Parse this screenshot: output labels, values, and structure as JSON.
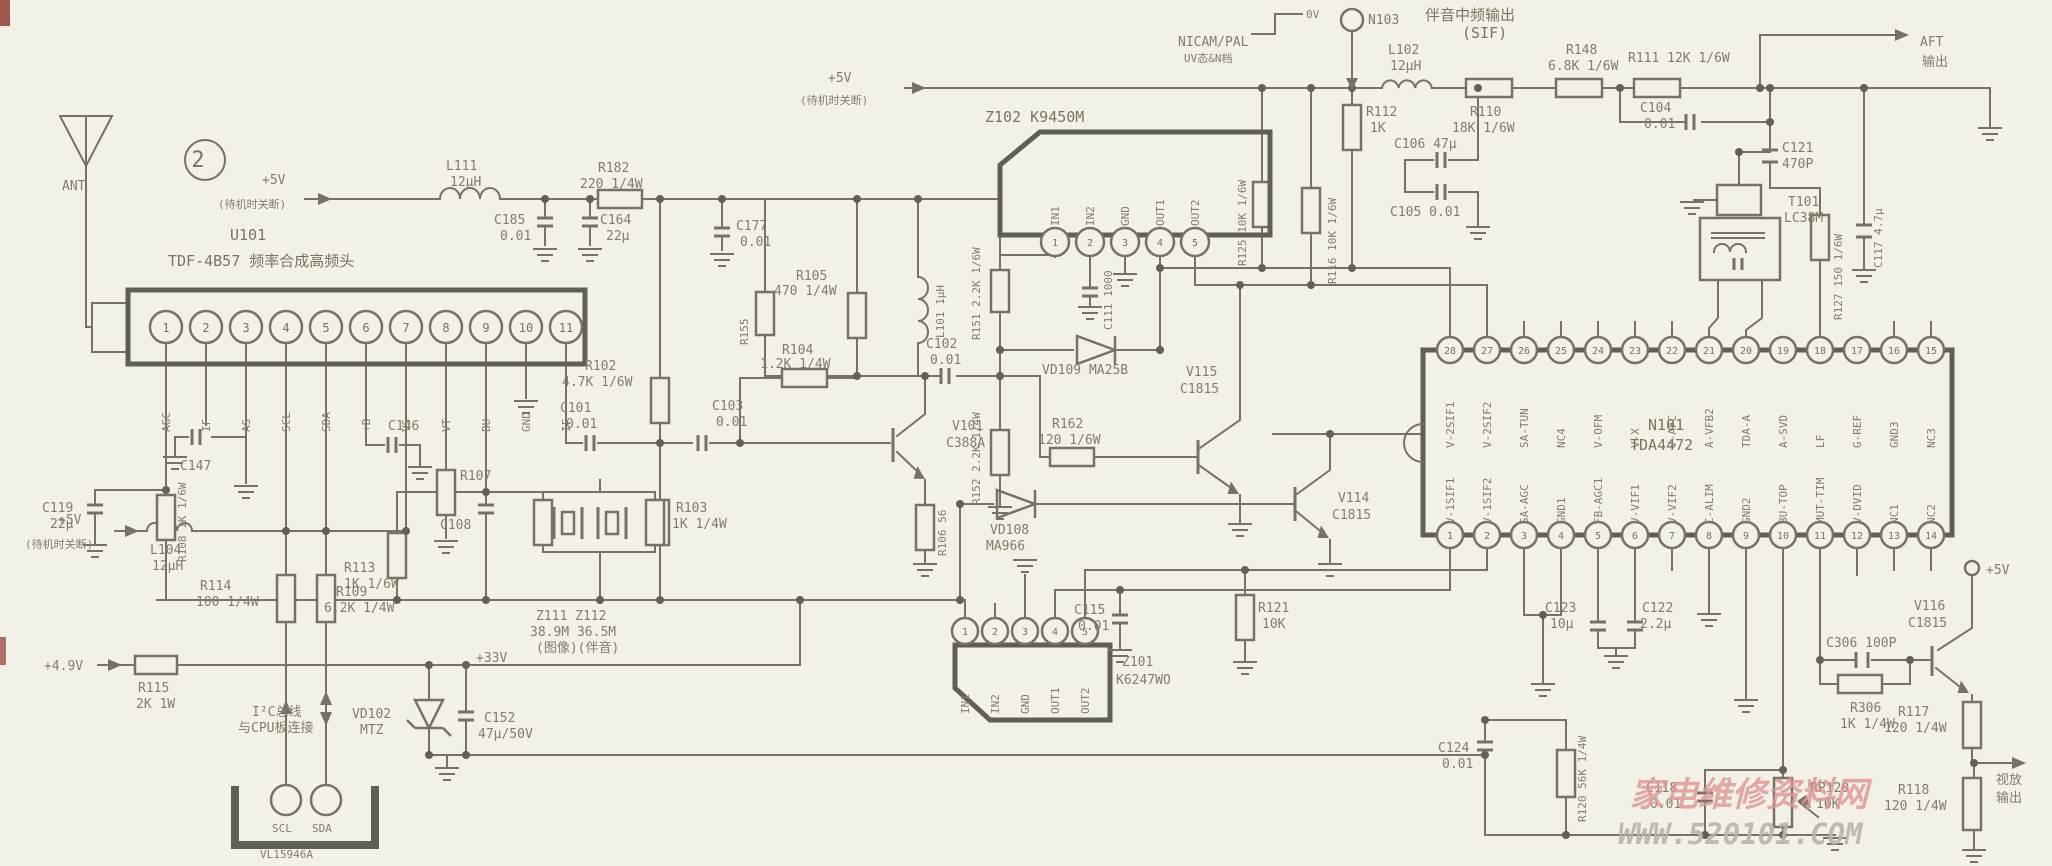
{
  "figure": "2",
  "watermark": {
    "site": "家电维修资料网",
    "url": "WWW.520101.COM"
  },
  "power": {
    "v5": "+5V",
    "v5_note": "(待机时关断)",
    "v49": "+4.9V",
    "v33": "+33V",
    "v5term": "+5V"
  },
  "io": {
    "ant": "ANT",
    "aft1": "AFT",
    "aft2": "输出",
    "out1": "视放",
    "out2": "输出",
    "sif1": "伴音中频输出",
    "sif2": "(SIF)",
    "n103": "N103",
    "nicam1": "NICAM/PAL",
    "nicam2": "UV态&N档",
    "nicam_lv": "0V",
    "i2c1": "I²C总线",
    "i2c2": "与CPU板连接",
    "scl": "SCL",
    "sda": "SDA",
    "conn_sub": "VL15946A"
  },
  "tuner": {
    "ref": "U101",
    "desc": "TDF-4B57 频率合成高频头",
    "pins": [
      "1",
      "2",
      "3",
      "4",
      "5",
      "6",
      "7",
      "8",
      "9",
      "10",
      "11"
    ],
    "pin_names": [
      "AGC",
      "IF",
      "AS",
      "SCL",
      "SDA",
      "+B",
      "VS",
      "VT",
      "BU",
      "GND",
      "IF"
    ]
  },
  "z102": {
    "label": "Z102 K9450M",
    "pins": [
      "1",
      "2",
      "3",
      "4",
      "5"
    ],
    "pin_names": [
      "IN1",
      "IN2",
      "GND",
      "OUT1",
      "OUT2"
    ]
  },
  "z101": {
    "l1": "Z101",
    "l2": "K6247WO",
    "pins": [
      "1",
      "2",
      "3",
      "4",
      "5"
    ],
    "pin_names": [
      "IN1",
      "IN2",
      "GND",
      "OUT1",
      "OUT2"
    ]
  },
  "n101": {
    "ref": "N101",
    "part": "TDA4472",
    "top_nums": [
      "28",
      "27",
      "26",
      "25",
      "24",
      "23",
      "22",
      "21",
      "20",
      "19",
      "18",
      "17",
      "16",
      "15"
    ],
    "top_names": [
      "V-2SIF1",
      "V-2SIF2",
      "SA-TUN",
      "NC4",
      "V-OFM",
      "V-X",
      "V-AFC",
      "A-VFB2",
      "TDA-A",
      "A-SVD",
      "LF",
      "G-REF",
      "GND3",
      "NC3"
    ],
    "bot_nums": [
      "1",
      "2",
      "3",
      "4",
      "5",
      "6",
      "7",
      "8",
      "9",
      "10",
      "11",
      "12",
      "13",
      "14"
    ],
    "bot_names": [
      "V-1SIF1",
      "V-1SIF2",
      "SA-AGC",
      "GND1",
      "FB-AGC1",
      "V-VIF1",
      "V-VIF2",
      "C-ALIM",
      "GND2",
      "BU-TOP",
      "MUT-TIM",
      "V-DVID",
      "NC1",
      "NC2"
    ]
  },
  "xtal": {
    "l1": "Z111 Z112",
    "l2": "38.9M 36.5M",
    "l3": "(图像)(伴音)"
  },
  "c": {
    "l111": [
      "L111",
      "12μH"
    ],
    "c185": [
      "C185",
      "0.01"
    ],
    "c164": [
      "C164",
      "22μ"
    ],
    "r182": [
      "R182",
      "220 1/4W"
    ],
    "c177": [
      "C177",
      "0.01"
    ],
    "r105": [
      "R105",
      "470 1/4W"
    ],
    "r104": [
      "R104",
      "1.2K 1/4W"
    ],
    "l101": "L101 1μH",
    "r102": [
      "R102",
      "4.7K 1/6W"
    ],
    "c101": [
      "C101",
      "0.01"
    ],
    "c103": [
      "C103",
      "0.01"
    ],
    "r103": [
      "R103",
      "1K 1/4W"
    ],
    "v101": [
      "V101",
      "C388A"
    ],
    "r106": "R106 56",
    "c102": [
      "C102",
      "0.01"
    ],
    "r151": "R151 2.2K 1/6W",
    "r152": "R152 2.2K 1/4W",
    "r155": "R155",
    "c111": "C111 1000",
    "vd109": "VD109 MA25B",
    "vd108": [
      "VD108",
      "MA966"
    ],
    "r162": [
      "R162",
      "120 1/6W"
    ],
    "v115": [
      "V115",
      "C1815"
    ],
    "v114": [
      "V114",
      "C1815"
    ],
    "c119": [
      "C119",
      "22μ"
    ],
    "r108": "R108 1K 1/6W",
    "c147": "C147",
    "c146": "C146",
    "r107": "R107",
    "c108": "C108",
    "l104": [
      "L104",
      "12μH"
    ],
    "r114": [
      "R114",
      "100 1/4W"
    ],
    "r113": [
      "R113",
      "1K 1/6W"
    ],
    "r109": [
      "R109",
      "6.2K 1/4W"
    ],
    "r115": [
      "R115",
      "2K 1W"
    ],
    "vd102": [
      "VD102",
      "MTZ"
    ],
    "c152": [
      "C152",
      "47μ/50V"
    ],
    "l102": [
      "L102",
      "12μH"
    ],
    "r112": [
      "R112",
      "1K"
    ],
    "r110": [
      "R110",
      "18K 1/6W"
    ],
    "c106": "C106 47μ",
    "c105": "C105 0.01",
    "r125": "R125 10K 1/6W",
    "r116": "R116 10K 1/6W",
    "r148": [
      "R148",
      "6.8K 1/6W"
    ],
    "r111": "R111 12K 1/6W",
    "c104": [
      "C104",
      "0.01"
    ],
    "c121": [
      "C121",
      "470P"
    ],
    "t101": [
      "T101",
      "LC38M"
    ],
    "c117": "C117 4.7μ",
    "r127": "R127 150 1/6W",
    "c123": [
      "C123",
      "10μ"
    ],
    "c122": [
      "C122",
      "2.2μ"
    ],
    "c115": [
      "C115",
      "0.01"
    ],
    "r121": [
      "R121",
      "10K"
    ],
    "c124": [
      "C124",
      "0.01"
    ],
    "r120": "R120 56K 1/4W",
    "c118": [
      "C118",
      "0.01"
    ],
    "rp120": [
      "RP120",
      "10K"
    ],
    "c306": "C306 100P",
    "r306": [
      "R306",
      "1K 1/4W"
    ],
    "v116": [
      "V116",
      "C1815"
    ],
    "r117": [
      "R117",
      "120 1/4W"
    ],
    "r118": [
      "R118",
      "120 1/4W"
    ]
  }
}
